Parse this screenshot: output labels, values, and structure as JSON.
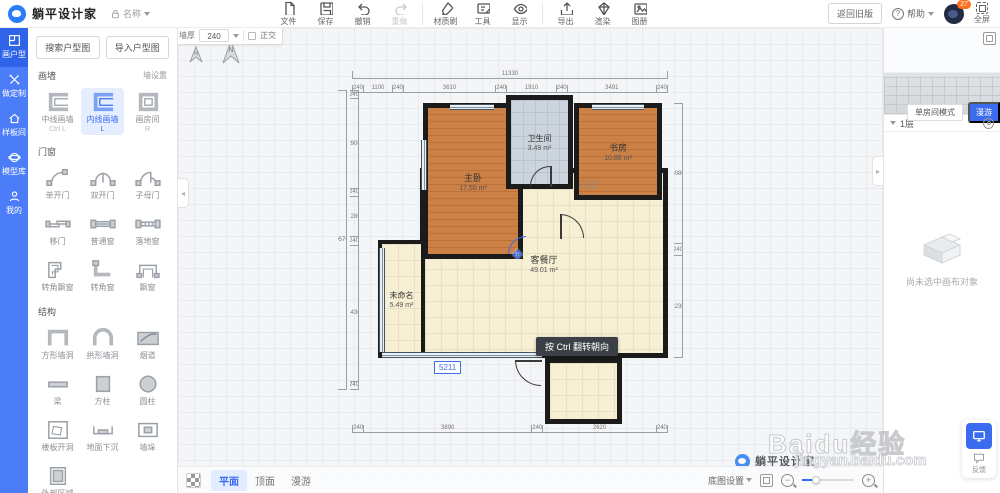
{
  "colors": {
    "accent": "#3b6cf0",
    "sidebar_blue": "#4c7df8",
    "wall": "#1b1b1b",
    "wood_floor": "#c67c42",
    "cream_floor": "#f6efd3",
    "bath_floor": "#ccd5dd",
    "badge_orange": "#ff6f1e"
  },
  "header": {
    "app_title": "躺平设计家",
    "doc_name": "名称",
    "toolbar": [
      {
        "label": "文件",
        "icon": "file-icon"
      },
      {
        "label": "保存",
        "icon": "save-icon"
      },
      {
        "label": "撤销",
        "icon": "undo-icon"
      },
      {
        "label": "重做",
        "icon": "redo-icon",
        "disabled": true
      },
      {
        "label": "材质刷",
        "icon": "brush-icon"
      },
      {
        "label": "工具",
        "icon": "tools-icon"
      },
      {
        "label": "显示",
        "icon": "eye-icon"
      },
      {
        "label": "导出",
        "icon": "export-icon"
      },
      {
        "label": "渲染",
        "icon": "render-icon"
      },
      {
        "label": "图册",
        "icon": "album-icon"
      }
    ],
    "back_old_label": "返回旧版",
    "help_label": "帮助",
    "notification_count": "27",
    "fullscreen_label": "全屏"
  },
  "sidebar": {
    "items": [
      {
        "label": "画户型",
        "active": true
      },
      {
        "label": "做定制"
      },
      {
        "label": "样板间"
      },
      {
        "label": "模型库"
      },
      {
        "label": "我的"
      }
    ]
  },
  "tool_panel": {
    "search_button": "搜索户型图",
    "import_button": "导入户型图",
    "sections": [
      {
        "title": "画墙",
        "link": "墙设置",
        "items": [
          {
            "label": "中线画墙",
            "shortcut": "Ctrl L"
          },
          {
            "label": "内线画墙",
            "shortcut": "L",
            "selected": true
          },
          {
            "label": "画房间",
            "shortcut": "R"
          }
        ]
      },
      {
        "title": "门窗",
        "items": [
          {
            "label": "单开门"
          },
          {
            "label": "双开门"
          },
          {
            "label": "子母门"
          },
          {
            "label": "移门"
          },
          {
            "label": "普通窗"
          },
          {
            "label": "落地窗"
          },
          {
            "label": "转角飘窗"
          },
          {
            "label": "转角窗"
          },
          {
            "label": "飘窗"
          }
        ]
      },
      {
        "title": "结构",
        "items": [
          {
            "label": "方形墙洞"
          },
          {
            "label": "拱形墙洞"
          },
          {
            "label": "烟道"
          },
          {
            "label": "梁"
          },
          {
            "label": "方柱"
          },
          {
            "label": "圆柱"
          },
          {
            "label": "楼板开洞"
          },
          {
            "label": "地面下沉"
          },
          {
            "label": "墙垛"
          },
          {
            "label": "外部区域"
          }
        ]
      }
    ]
  },
  "canvas": {
    "wall_bar": {
      "label": "墙厚",
      "value": "240",
      "ortho": "正交"
    },
    "rooms": [
      {
        "name": "主卧",
        "area": "17.50 m²"
      },
      {
        "name": "卫生间",
        "area": "3.49 m²"
      },
      {
        "name": "书房",
        "area": "10.88 m²"
      },
      {
        "name": "入口",
        "area": ""
      },
      {
        "name": "客餐厅",
        "area": "49.01 m²"
      },
      {
        "name": "未命名",
        "area": "5.49 m²"
      }
    ],
    "tooltip": "按 Ctrl 翻转朝向",
    "dim_input": "5211",
    "dims": {
      "top_total": "11330",
      "top": [
        "240",
        "1100",
        "240",
        "3610",
        "240",
        "1910",
        "240",
        "3491",
        "240"
      ],
      "left_total": "9570",
      "left": [
        "240",
        "2900",
        "240",
        "1280",
        "240",
        "4430",
        "240"
      ],
      "bottom": [
        "240",
        "3890",
        "240",
        "2620",
        "240"
      ],
      "right": [
        "3080",
        "240",
        "2230"
      ]
    },
    "view_tabs": [
      {
        "label": "平面",
        "active": true
      },
      {
        "label": "顶面"
      },
      {
        "label": "漫游"
      }
    ],
    "base_map_label": "底图设置",
    "watermark_brand": "躺平设计家",
    "watermark_baidu": "Baidu经验",
    "watermark_url": "jingyan.baidu.com"
  },
  "right_panel": {
    "single_room_label": "单房间模式",
    "roam_label": "漫游",
    "floor_label": "1层",
    "empty_text": "尚未选中画布对象",
    "feedback_label": "反馈"
  }
}
